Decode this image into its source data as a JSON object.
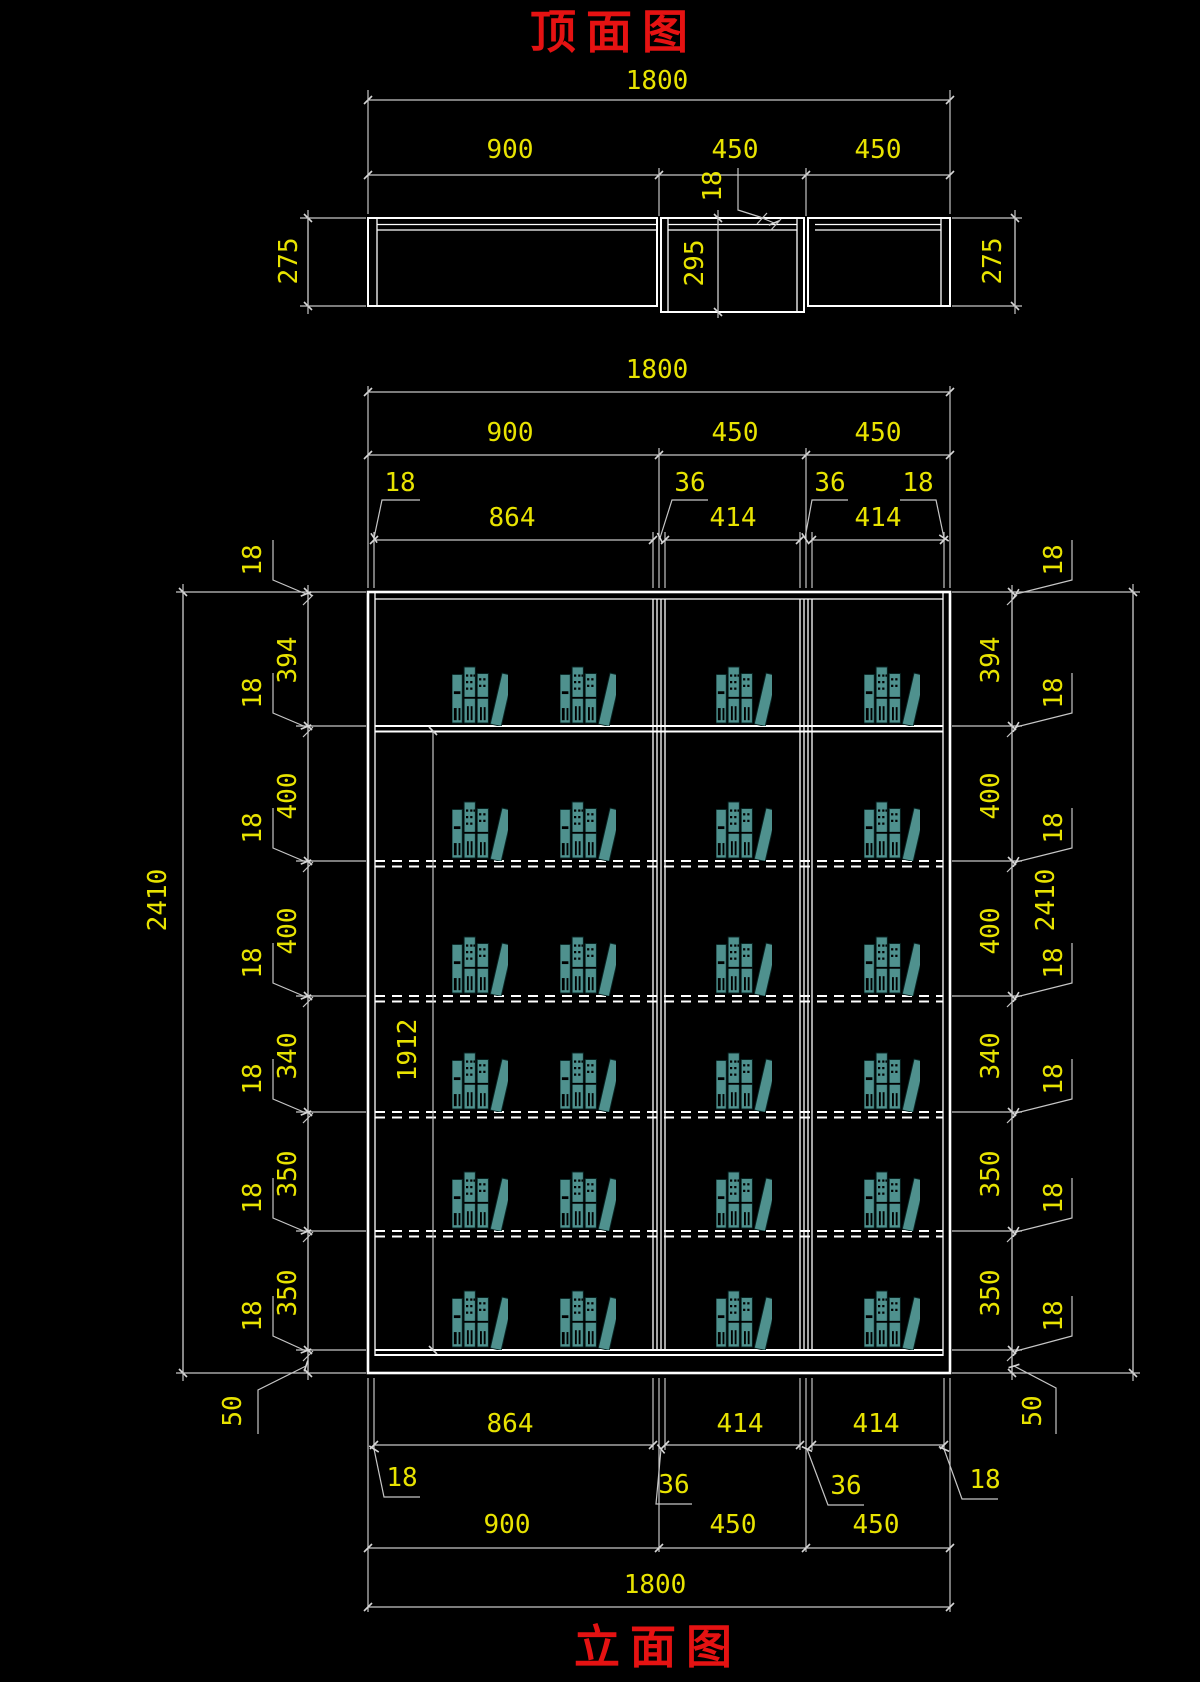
{
  "titles": {
    "top": "顶面图",
    "bottom": "立面图"
  },
  "colors": {
    "background": "#000000",
    "drawing_line": "#ffffff",
    "dimension_line": "#c6c6c6",
    "dimension_text": "#e8e300",
    "title_text": "#e51212",
    "books": "#4f918e"
  },
  "top_view": {
    "overall": "1800",
    "segments": [
      "900",
      "450",
      "450"
    ],
    "panel_thickness": "18",
    "depth_left": "275",
    "depth_middle": "295",
    "depth_right": "275"
  },
  "elevation_top": {
    "overall": "1800",
    "segments": [
      "900",
      "450",
      "450"
    ],
    "leaders": [
      "18",
      "36",
      "36",
      "18"
    ],
    "inner_widths": [
      "864",
      "414",
      "414"
    ]
  },
  "elevation_left": {
    "total": "2410",
    "interior": "1912",
    "compartments": [
      "394",
      "400",
      "400",
      "340",
      "350",
      "350"
    ],
    "panel": "18",
    "base": "50"
  },
  "elevation_right": {
    "total": "2410",
    "compartments": [
      "394",
      "400",
      "400",
      "340",
      "350",
      "350"
    ],
    "panel": "18",
    "base": "50"
  },
  "elevation_bottom": {
    "inner_widths": [
      "864",
      "414",
      "414"
    ],
    "leaders": [
      "18",
      "36",
      "36",
      "18"
    ],
    "segments": [
      "900",
      "450",
      "450"
    ],
    "overall": "1800"
  }
}
